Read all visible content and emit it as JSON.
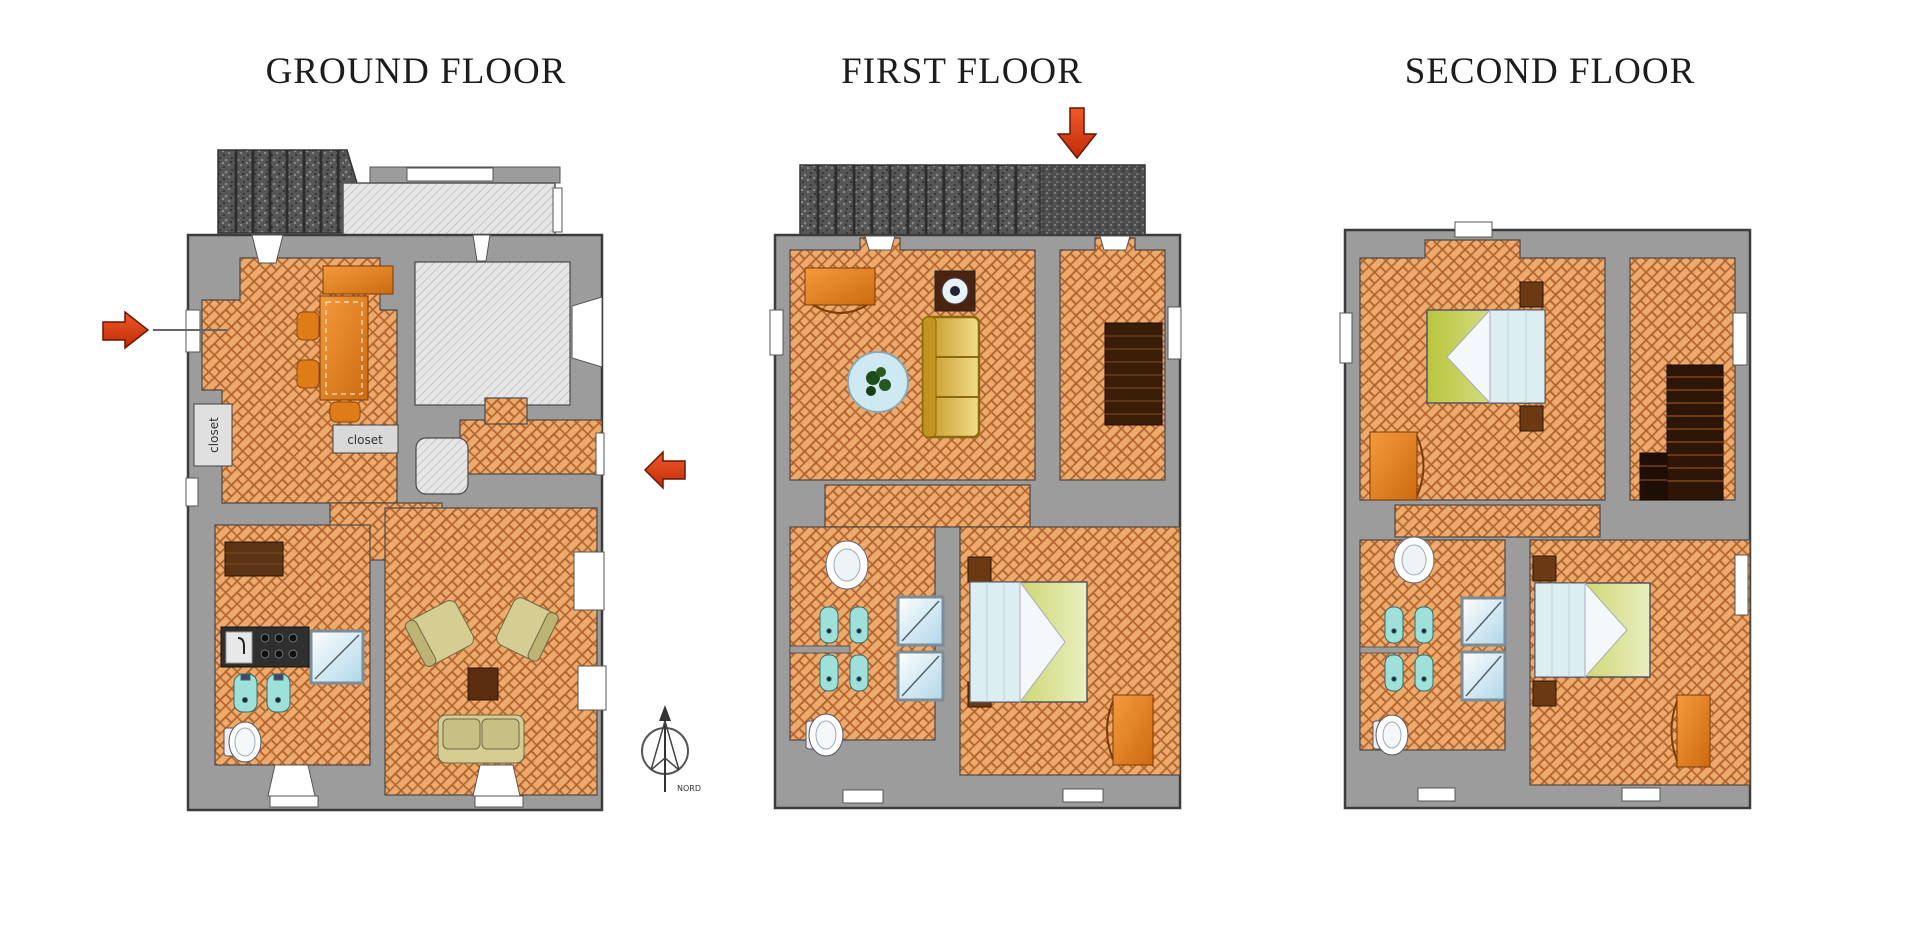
{
  "page": {
    "background": "#ffffff"
  },
  "floors": [
    {
      "id": "ground",
      "title": "GROUND FLOOR"
    },
    {
      "id": "first",
      "title": "FIRST FLOOR"
    },
    {
      "id": "second",
      "title": "SECOND FLOOR"
    }
  ],
  "labels": {
    "closet_wall": "closet",
    "closet_hall": "closet",
    "compass_north": "NORD"
  },
  "colors": {
    "wall": "#9c9c9c",
    "wall_outline": "#3c3c3c",
    "floor_tile": "#ecaa6b",
    "tile_joint": "#b2622f",
    "roof_dark": "#565656",
    "hatch_bg": "#e6e6e6",
    "arrow_red": "#d9411e",
    "furniture_orange": "#e07c18",
    "sofa_yellow": "#e3c561",
    "bed_green": "#c3cf45",
    "fixture_cyan": "#9fe0da",
    "armchair_khaki": "#d5cd92",
    "wood_dark": "#5a2d0e"
  }
}
